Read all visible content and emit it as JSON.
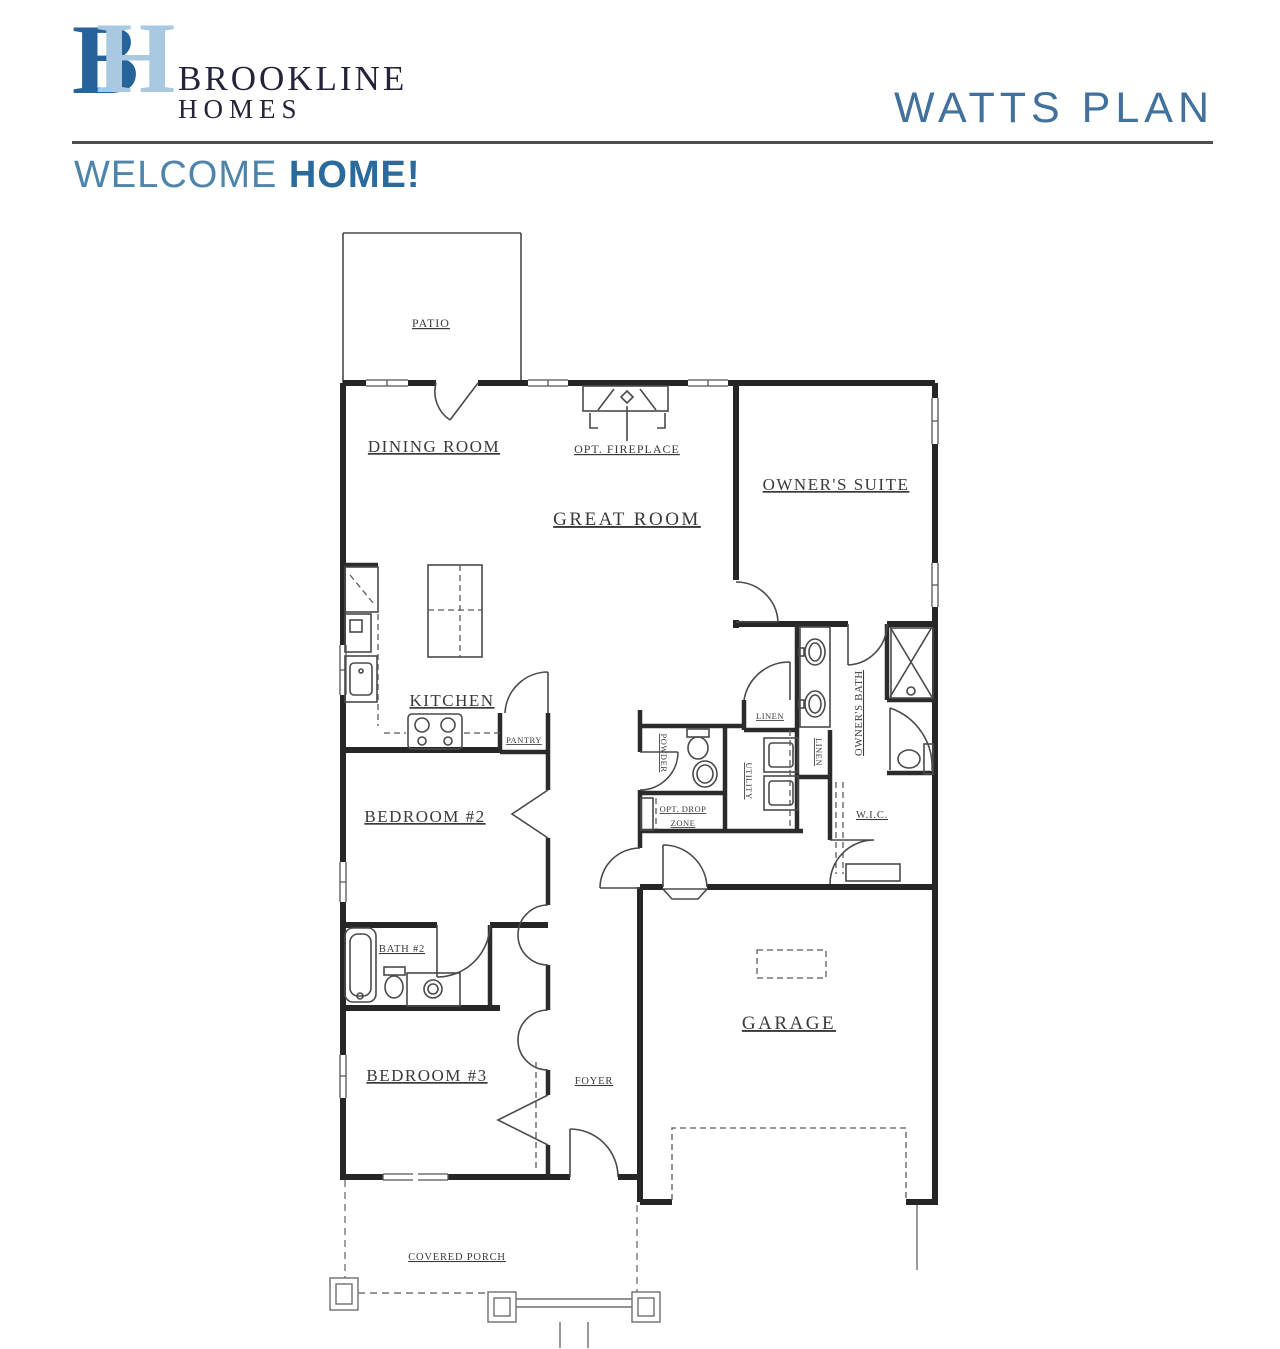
{
  "header": {
    "logo": {
      "letter_b": "B",
      "letter_h": "H",
      "name_line1": "BROOKLINE",
      "name_line2": "HOMES"
    },
    "plan_title": "WATTS PLAN",
    "welcome_normal": "WELCOME ",
    "welcome_bold": "HOME!"
  },
  "colors": {
    "brand_blue_dark": "#26639b",
    "brand_blue_light": "#a9c9e3",
    "brand_text": "#232339",
    "plan_title_blue": "#41719c",
    "welcome_blue": "#4d84aa",
    "welcome_bold_blue": "#2b6a9d",
    "divider_gray": "#4f4f4f",
    "plan_line": "#262626"
  },
  "floorplan": {
    "labels": {
      "patio": "PATIO",
      "dining_room": "DINING ROOM",
      "opt_fireplace": "OPT. FIREPLACE",
      "great_room": "GREAT ROOM",
      "owners_suite": "OWNER'S SUITE",
      "kitchen": "KITCHEN",
      "pantry": "PANTRY",
      "linen_bath": "LINEN",
      "owners_bath": "OWNER'S BATH",
      "bedroom_2": "BEDROOM #2",
      "powder": "POWDER",
      "utility": "UTILITY",
      "linen_hall": "LINEN",
      "wic": "W.I.C.",
      "opt_drop_zone_line1": "OPT. DROP",
      "opt_drop_zone_line2": "ZONE",
      "bath_2": "BATH #2",
      "garage": "GARAGE",
      "bedroom_3": "BEDROOM #3",
      "foyer": "FOYER",
      "covered_porch": "COVERED PORCH"
    }
  }
}
